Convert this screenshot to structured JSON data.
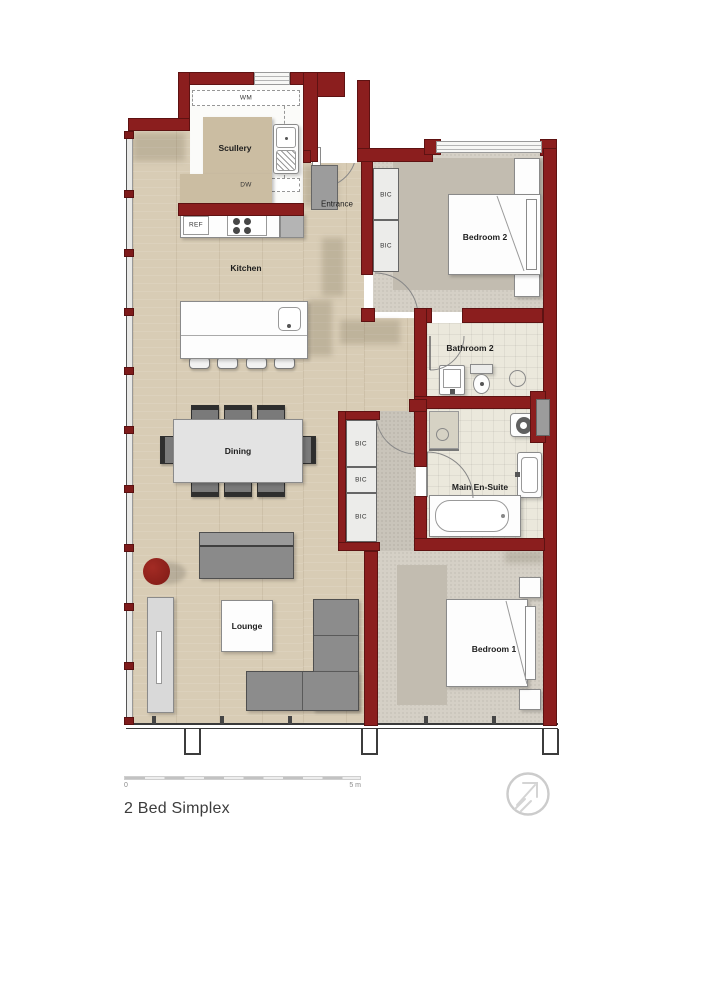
{
  "title": "2 Bed Simplex",
  "scale_bar": {
    "start_label": "0",
    "end_label": "5 m"
  },
  "rooms": {
    "scullery": "Scullery",
    "kitchen": "Kitchen",
    "entrance": "Entrance",
    "bedroom2": "Bedroom 2",
    "bathroom2": "Bathroom 2",
    "main_ensuite": "Main En-Suite",
    "bedroom1": "Bedroom 1",
    "dining": "Dining",
    "lounge": "Lounge"
  },
  "labels": {
    "wm": "WM",
    "dw": "DW",
    "ref": "REF",
    "bic": "BIC"
  },
  "colors": {
    "wall": "#8b1e1e",
    "wood_floor": "#d8ccb5",
    "carpet": "#d5d0c6",
    "tile": "#ebe8dc",
    "hallway": "#c9c4ba",
    "accent_red": "#8e221c",
    "furniture_gray": "#8c8c8c"
  }
}
